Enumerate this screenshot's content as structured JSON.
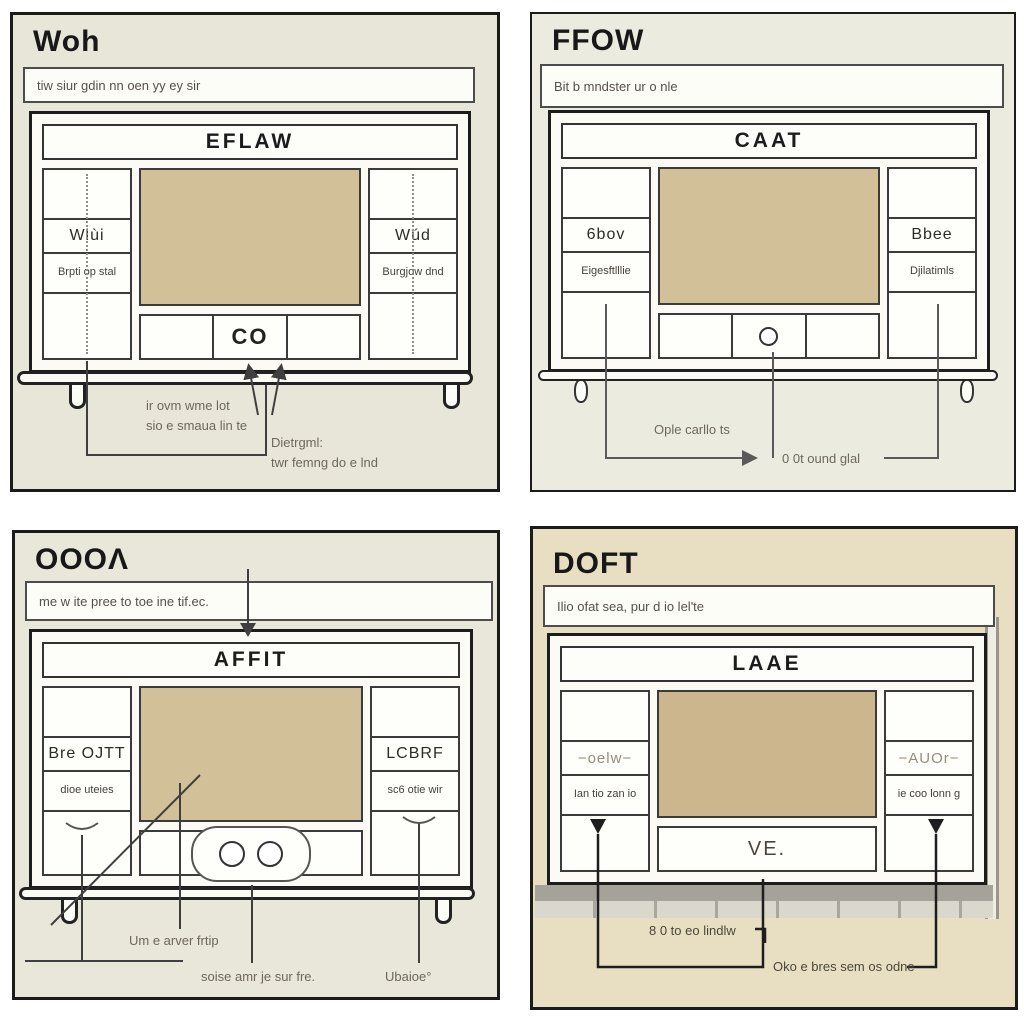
{
  "figure": {
    "description": "Four-panel line-art diagram of a TV console cabinet with garbled annotation text",
    "grid": "2x2"
  },
  "colors": {
    "panel_bg_top_left": "#e8e5d9",
    "panel_bg_top_right": "#ecebe0",
    "panel_bg_bottom_left": "#e9e6da",
    "panel_bg_bottom_right": "#e8dfc2",
    "screen_tan": "#d2c098",
    "outline_dark": "#1b1b1b",
    "annotation_gray": "#6e685c"
  },
  "panels": {
    "tl": {
      "title": "Woh",
      "subtitle": "tiw siur gdin nn oen yy ey sir",
      "cabinet": {
        "header": "EFLAW",
        "left_mid": "Wlùi",
        "left_low": "Brpti op stal",
        "right_mid": "Wúd",
        "right_low": "Burgjow dnd",
        "drawer": "CO"
      },
      "notes": {
        "n1a": "ir ovm wme lot",
        "n1b": "sio e smaua lin te",
        "n2a": "Dietrgml:",
        "n2b": "twr femng do e lnd"
      }
    },
    "tr": {
      "title": "FFOW",
      "subtitle": "Bit b mndster ur o nle",
      "cabinet": {
        "header": "CAAT",
        "left_mid": "6bov",
        "left_low": "Eigesftlllie",
        "right_mid": "Bbee",
        "right_low": "Djilatimls"
      },
      "notes": {
        "n1": "Ople carllo ts",
        "n2": "0 0t ound glal"
      }
    },
    "bl": {
      "title": "OOOΛ",
      "subtitle": "me w ite pree to toe ine tif.ec.",
      "cabinet": {
        "header": "AFFIT",
        "left_mid": "Bre OJTT",
        "left_low": "dioe uteies",
        "right_mid": "LCBRF",
        "right_low": "sc6 otie wir"
      },
      "notes": {
        "n1": "Um e arver frtip",
        "n2": "soise amr je sur fre.",
        "n3": "Ubaioe°"
      }
    },
    "br": {
      "title": "DOFT",
      "subtitle": "Ilio ofat sea, pur d io lel'te",
      "cabinet": {
        "header": "LAAE",
        "left_mid": "−oelw−",
        "left_low": "Ian tio zan io",
        "right_mid": "−AUOr−",
        "right_low": "ie coo lonn g",
        "drawer": "VE."
      },
      "notes": {
        "n1": "8 0 to eo lindlw",
        "n2": "Oko e bres sem os odne"
      }
    }
  }
}
